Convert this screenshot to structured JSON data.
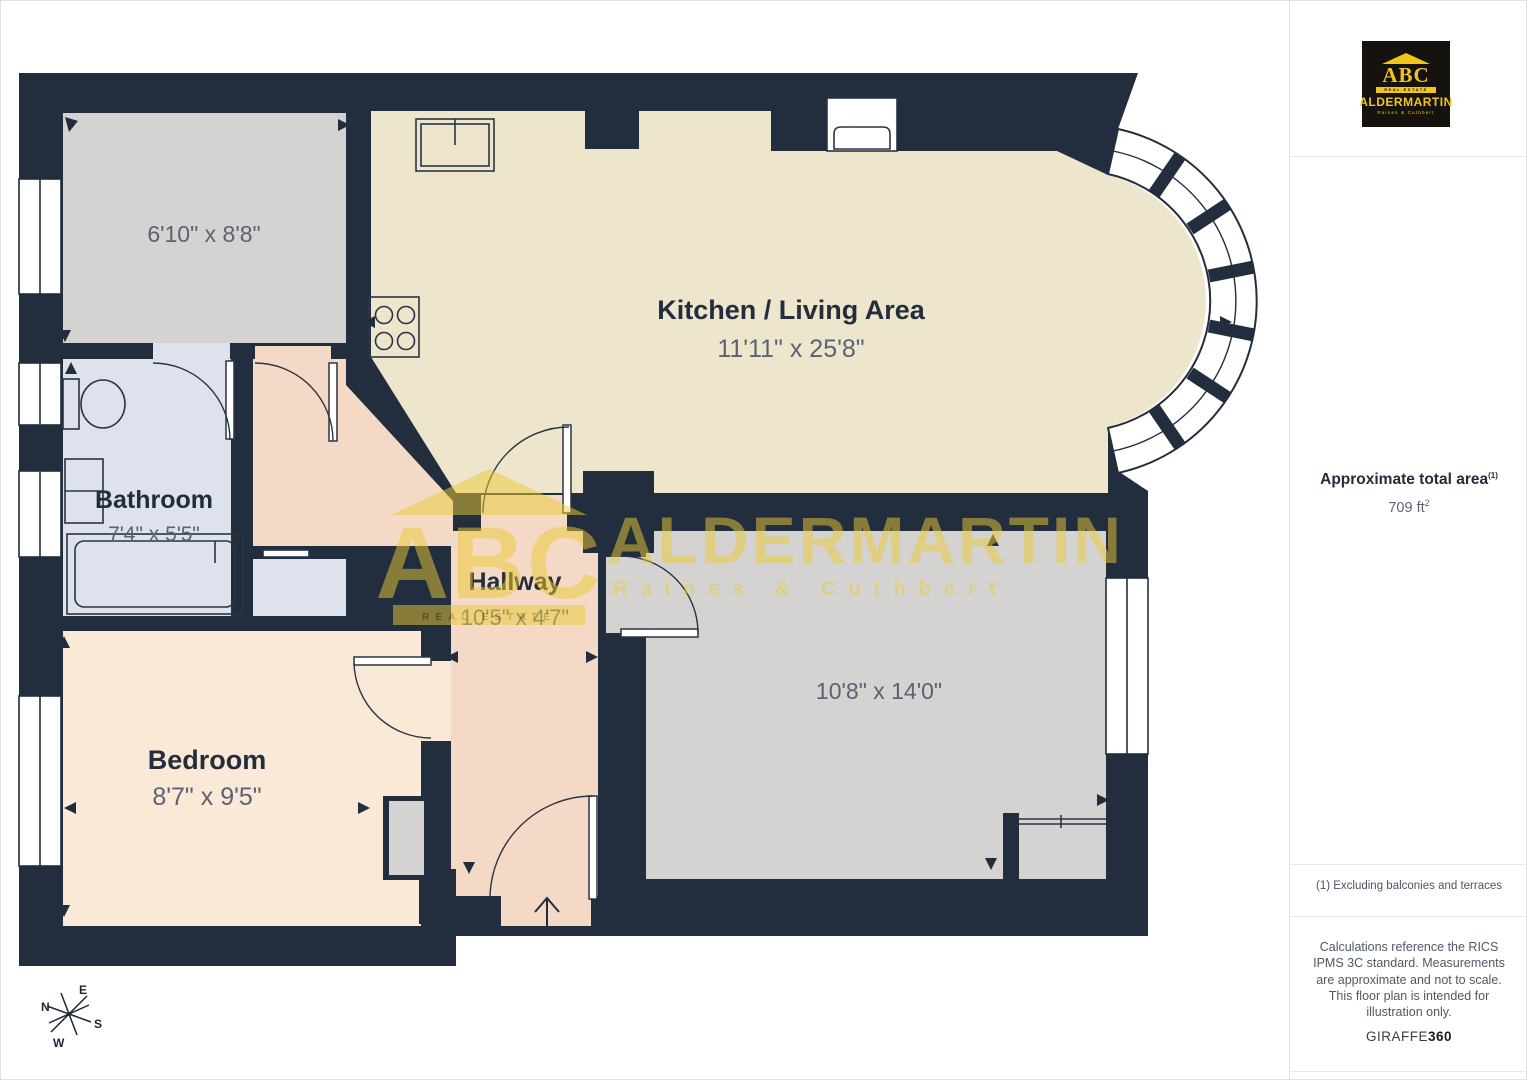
{
  "plan": {
    "rooms": [
      {
        "id": "store-top-left",
        "name": "",
        "dims": "6'10\" x 8'8\""
      },
      {
        "id": "kitchen-living",
        "name": "Kitchen / Living Area",
        "dims": "11'11\" x 25'8\""
      },
      {
        "id": "bathroom",
        "name": "Bathroom",
        "dims": "7'4\" x 5'5\""
      },
      {
        "id": "hallway",
        "name": "Hallway",
        "dims": "10'5\" x 4'7\""
      },
      {
        "id": "bedroom",
        "name": "Bedroom",
        "dims": "8'7\" x 9'5\""
      },
      {
        "id": "reception-bottom-right",
        "name": "",
        "dims": "10'8\" x 14'0\""
      }
    ],
    "compass": {
      "n": "N",
      "e": "E",
      "s": "S",
      "w": "W"
    }
  },
  "watermark": {
    "abc": "ABC",
    "banner": "REAL ESTATE",
    "name": "ALDERMARTIN",
    "sub": "Raines & Cuthbert"
  },
  "sidebar": {
    "logo": {
      "abc": "ABC",
      "banner": "REAL ESTATE",
      "name": "ALDERMARTIN",
      "sub": "Raines & Cuthbert"
    },
    "area_label": "Approximate total area",
    "area_sup": "(1)",
    "area_value": "709 ft",
    "area_unit_sup": "2",
    "footnote": "(1) Excluding balconies and terraces",
    "disclaimer": "Calculations reference the RICS IPMS 3C standard. Measurements are approximate and not to scale. This floor plan is intended for illustration only.",
    "brand": {
      "giraffe": "GIRAFFE",
      "n360": "360"
    }
  },
  "colors": {
    "wall": "#222d3e",
    "kitchen": "#ede6cd",
    "bathroom": "#dee2ec",
    "hallway": "#f4dac6",
    "bedroom": "#fbe9d8",
    "gray_room": "#d4d3d1",
    "watermark_yellow": "#ecca35",
    "logo_yellow": "#f2c51d",
    "logo_bg": "#16130e"
  }
}
